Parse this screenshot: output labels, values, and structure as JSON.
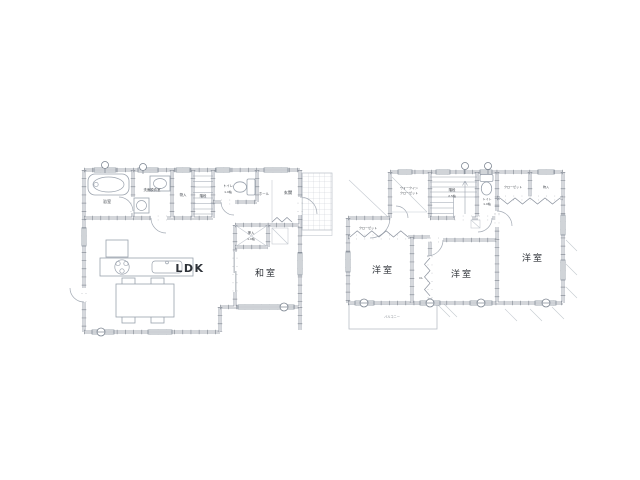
{
  "title": "間取り図",
  "colors": {
    "background": "#ffffff",
    "wall_line": "#8b929e",
    "wall_tick": "#6f7681",
    "fixture_line": "#9aa2ad",
    "tile_grid": "#c8ccd2",
    "label_dark": "#2e3238",
    "label_small": "#41464d"
  },
  "floor1": {
    "labels": {
      "ldk": "LDK",
      "washitsu": "和室",
      "bath": "浴室",
      "washroom": "洗面脱衣室",
      "storage": "物入",
      "stairs": "階段",
      "toilet": "トイレ",
      "toilet_size": "1.0帖",
      "hall": "ホール",
      "entrance": "玄関",
      "oshiire": "押入",
      "oshiire_size": "1.0帖"
    }
  },
  "floor2": {
    "labels": {
      "bedroom_left": "洋室",
      "bedroom_middle": "洋室",
      "bedroom_right": "洋室",
      "wic_line1": "ウォークイン",
      "wic_line2": "クローゼット",
      "stairs": "階段",
      "stairs_size": "2.5帖",
      "toilet": "トイレ",
      "toilet_size": "1.0帖",
      "closet_top": "クローゼット",
      "storage_top": "物入",
      "closet_left": "クローゼット",
      "closet_middle": "CL",
      "balcony": "バルコニー"
    }
  }
}
